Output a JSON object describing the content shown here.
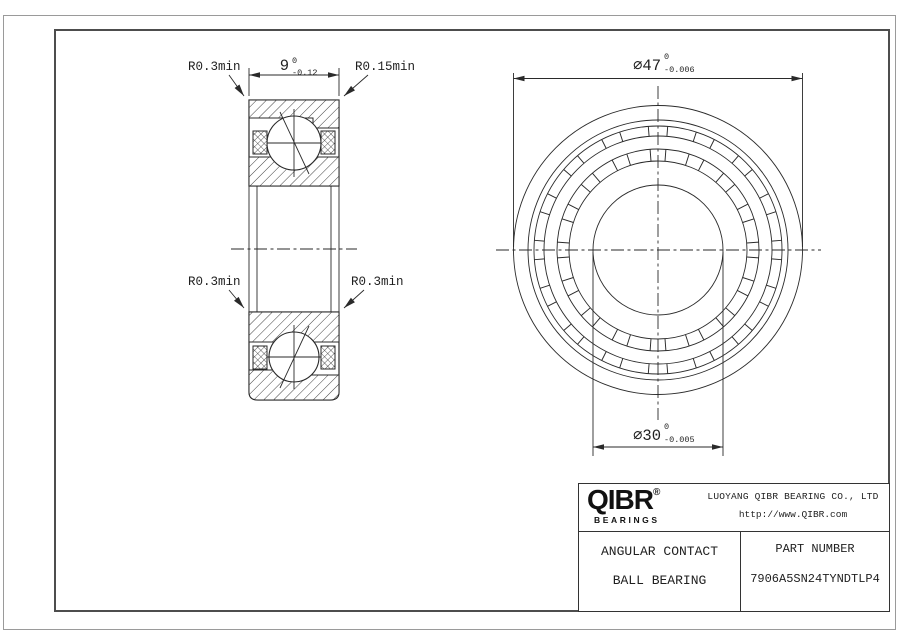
{
  "drawing": {
    "section_view": {
      "labels": {
        "top_left": "R0.3min",
        "top_right": "R0.15min",
        "bottom_left": "R0.3min",
        "bottom_right": "R0.3min"
      },
      "width_dim": {
        "value": "9",
        "upper": "0",
        "lower": "-0.12"
      }
    },
    "front_view": {
      "od_dim": {
        "value": "∅47",
        "upper": "0",
        "lower": "-0.006"
      },
      "bore_dim": {
        "value": "∅30",
        "upper": "0",
        "lower": "-0.005"
      }
    },
    "title_block": {
      "brand": "QIBR",
      "registered_mark": "®",
      "brand_sub": "BEARINGS",
      "company": "LUOYANG QIBR BEARING CO., LTD",
      "website": "http://www.QIBR.com",
      "product_line1": "ANGULAR CONTACT",
      "product_line2": "BALL BEARING",
      "part_number_label": "PART NUMBER",
      "part_number": "7906A5SN24TYNDTLP4"
    },
    "colors": {
      "line": "#2a2a2a",
      "frame_outer": "#9a9a9a",
      "frame_inner": "#4d4d4d",
      "background": "#ffffff"
    }
  }
}
